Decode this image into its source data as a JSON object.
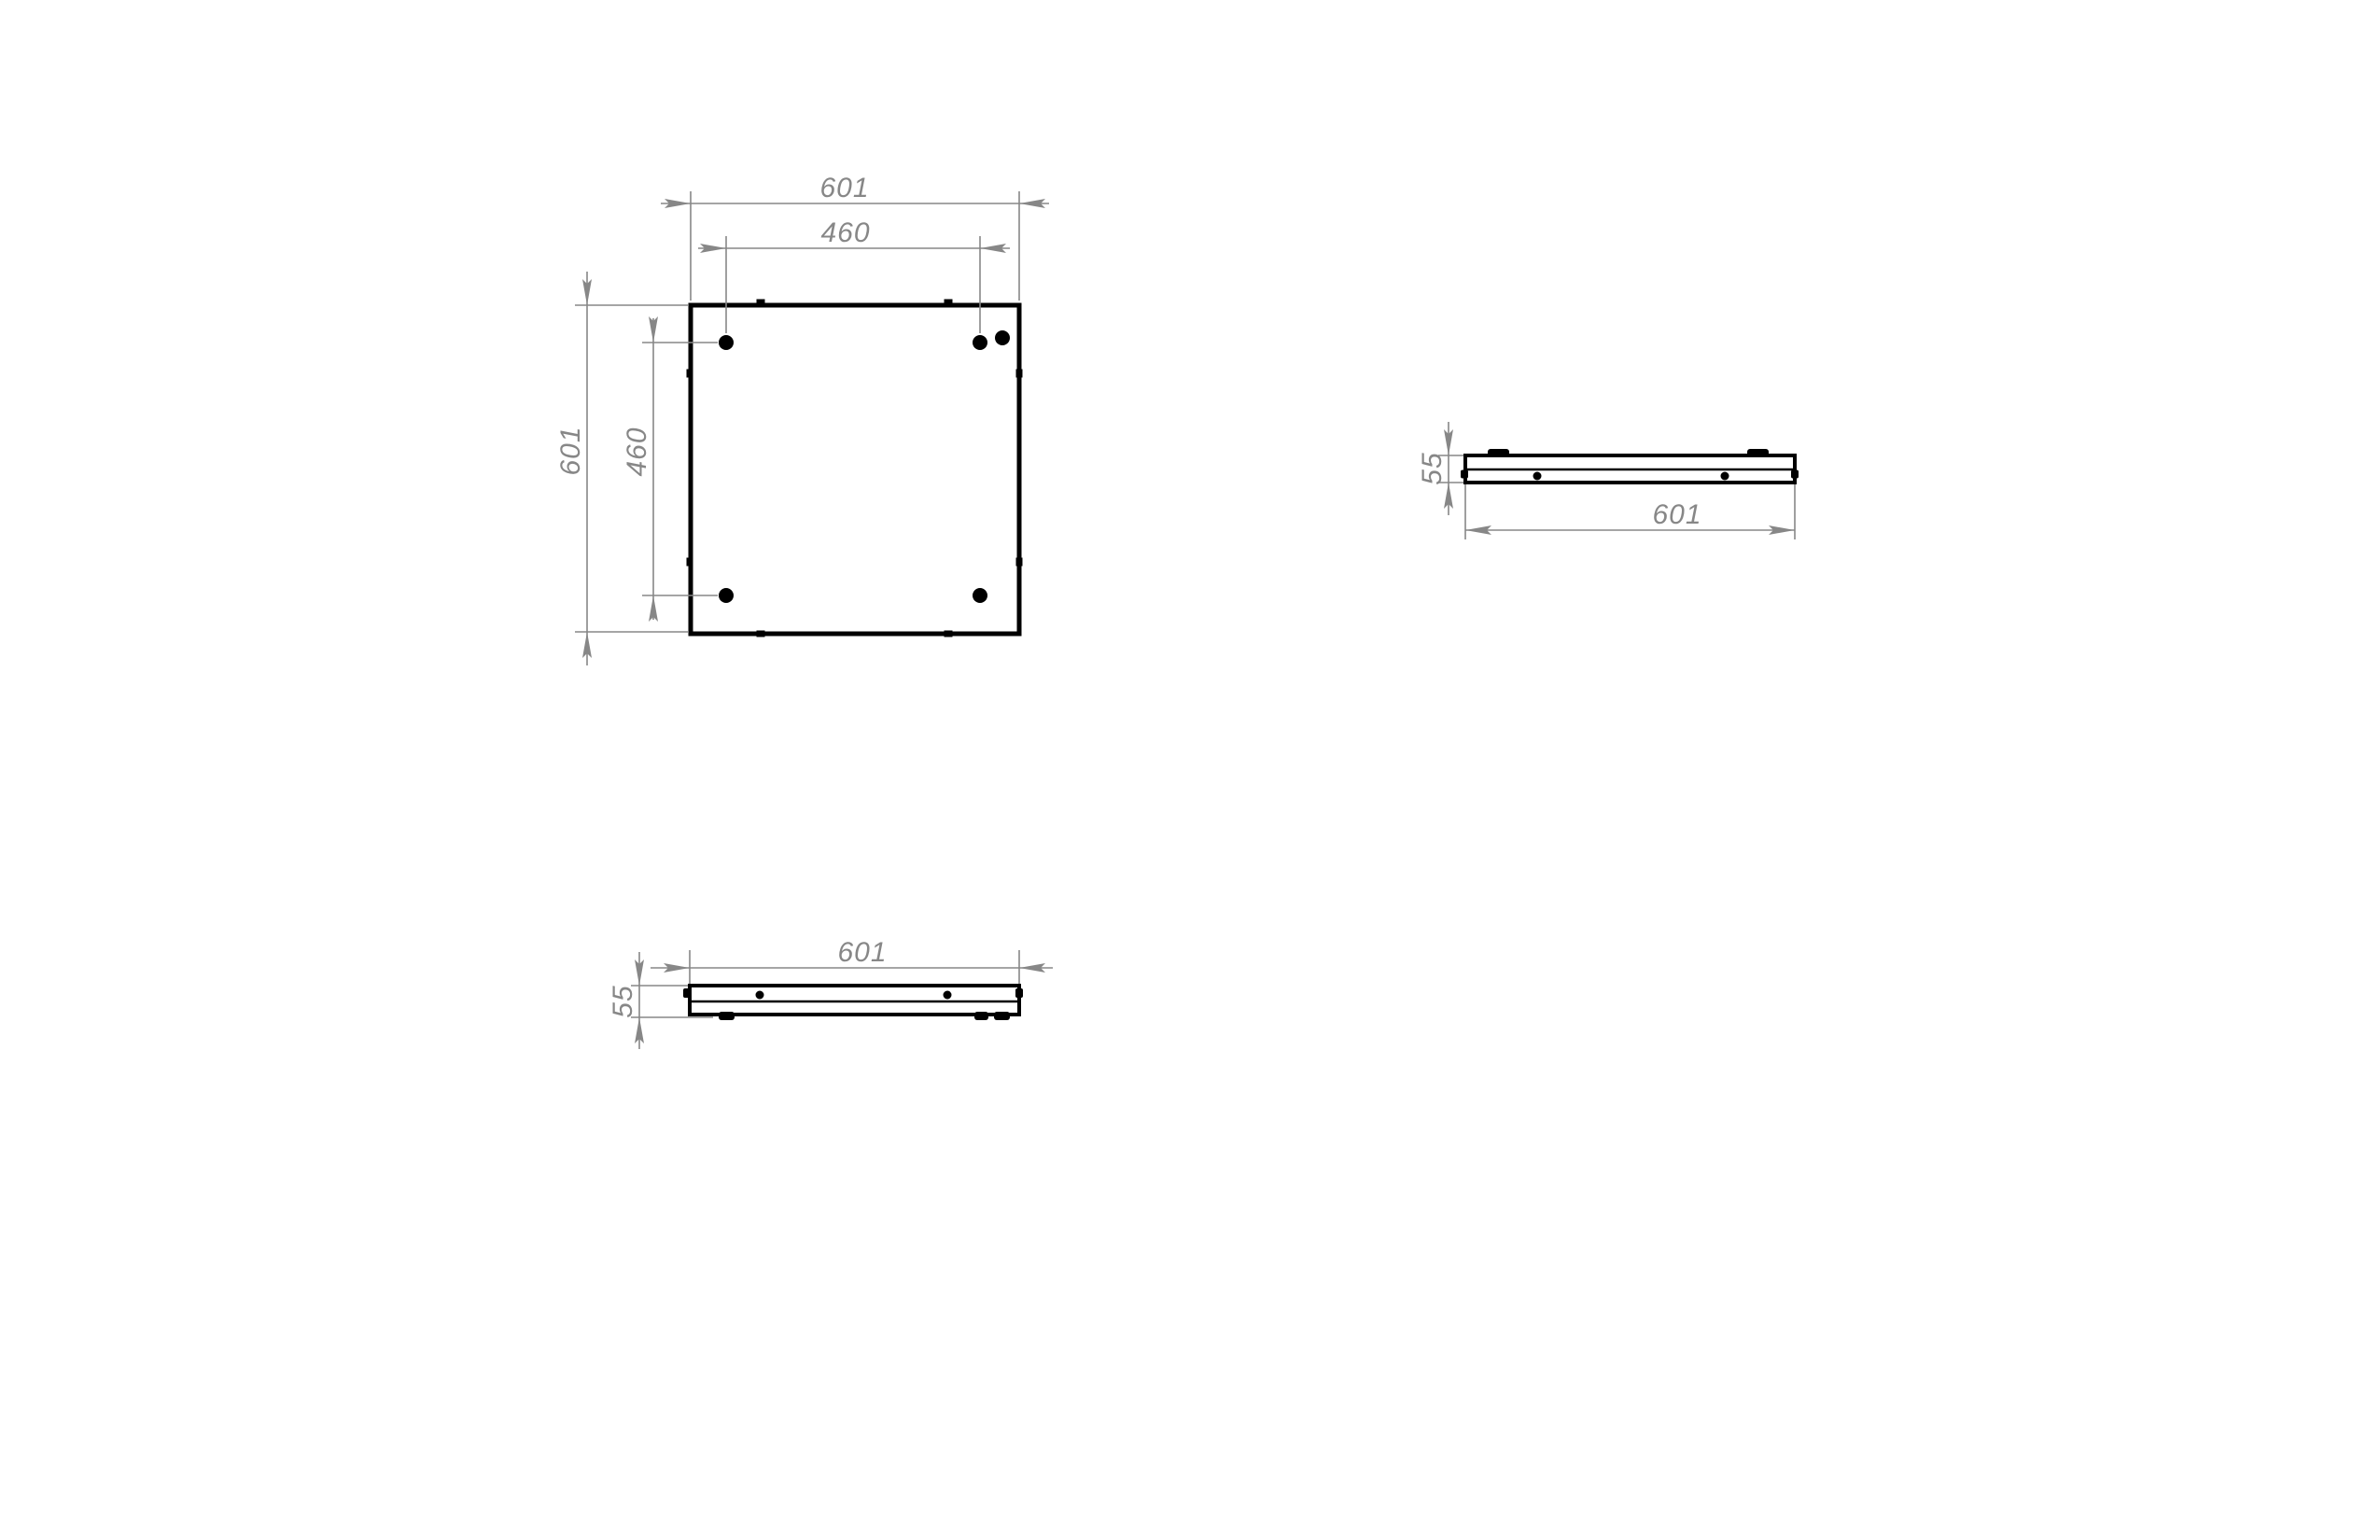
{
  "colors": {
    "part_line": "#000000",
    "dim_line": "#878787",
    "background": "#ffffff"
  },
  "labels": {
    "plan": {
      "width_outer": "601",
      "holes_width": "460",
      "height_outer": "601",
      "holes_height": "460"
    },
    "side_right": {
      "thickness": "55",
      "width": "601"
    },
    "side_bottom": {
      "width": "601",
      "thickness": "55"
    }
  }
}
